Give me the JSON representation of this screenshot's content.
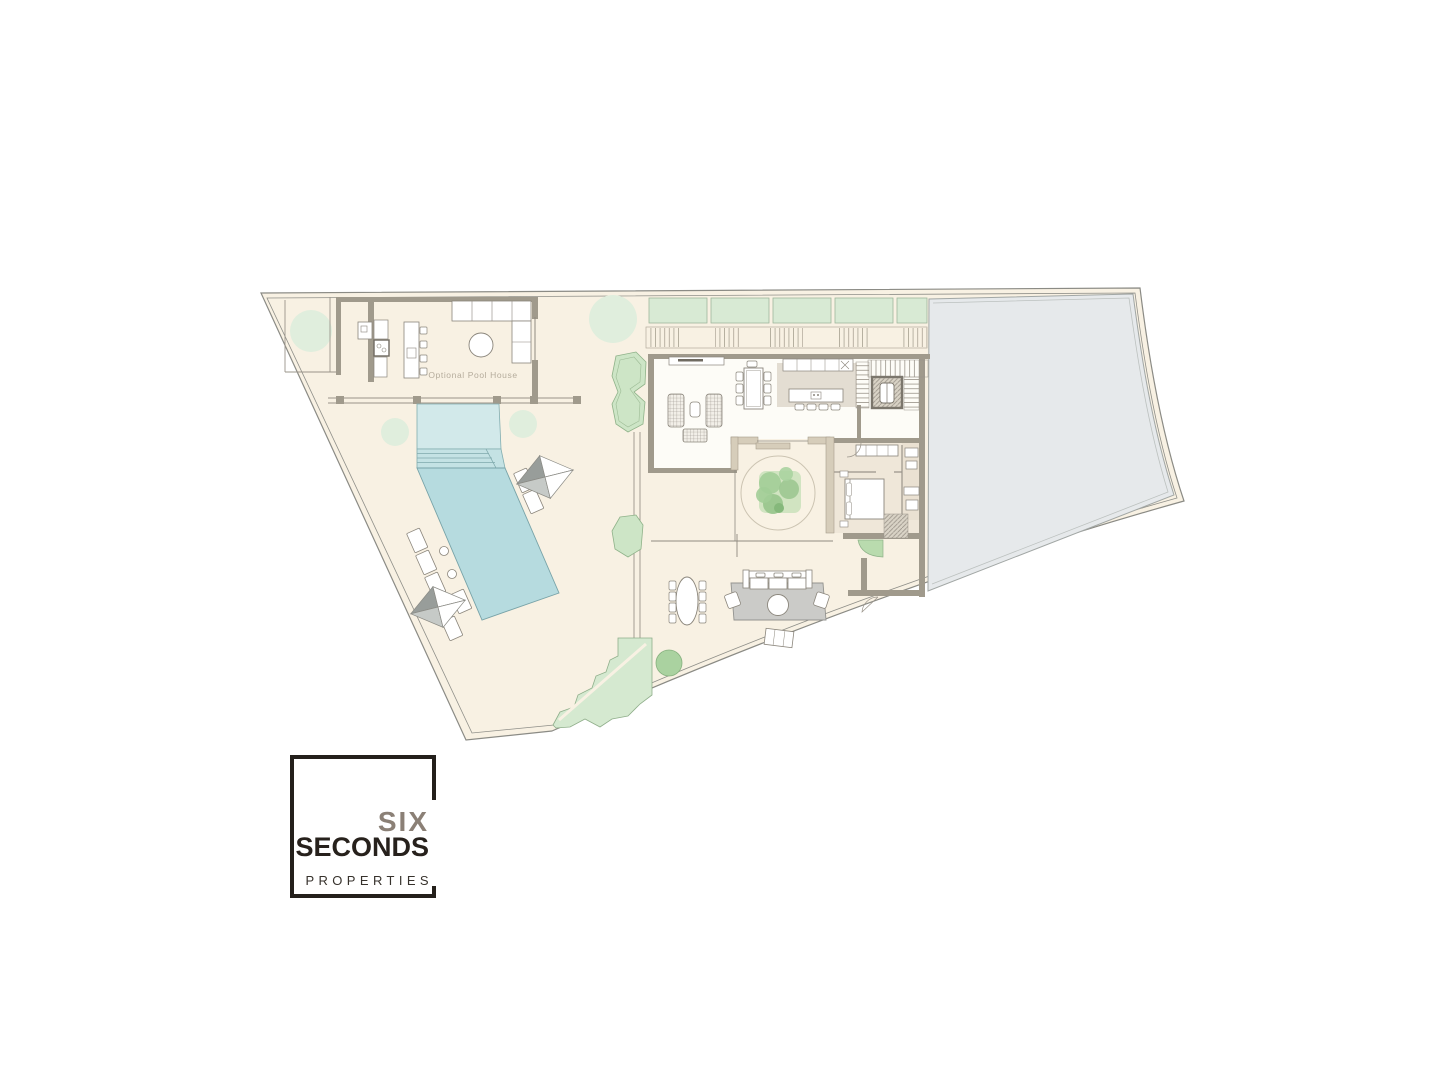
{
  "plan": {
    "pool_house_label": "Optional Pool House",
    "colors": {
      "plot_fill": "#f8f1e3",
      "neighbor_fill": "#e6e9eb",
      "pool_shallow": "#d2e9ea",
      "pool_steps": "#c4e2e4",
      "pool_deep": "#b6dbdf",
      "planter_green": "#d8ead4",
      "faded_tree_green": "#e0eedd",
      "bush_green": "#aad2a0",
      "wall_gray": "#a09a8c",
      "wall_beige": "#d6cdba",
      "rug_gray": "#cbcbc8",
      "boundary_line": "#8b8b85",
      "label_gray": "#b5ac9c"
    }
  },
  "logo": {
    "word_top": "SIX",
    "word_main": "SECONDS",
    "word_sub": "PROPERTIES",
    "border_color": "#24201b",
    "word_top_color": "#8b8076",
    "word_main_color": "#27211c"
  }
}
